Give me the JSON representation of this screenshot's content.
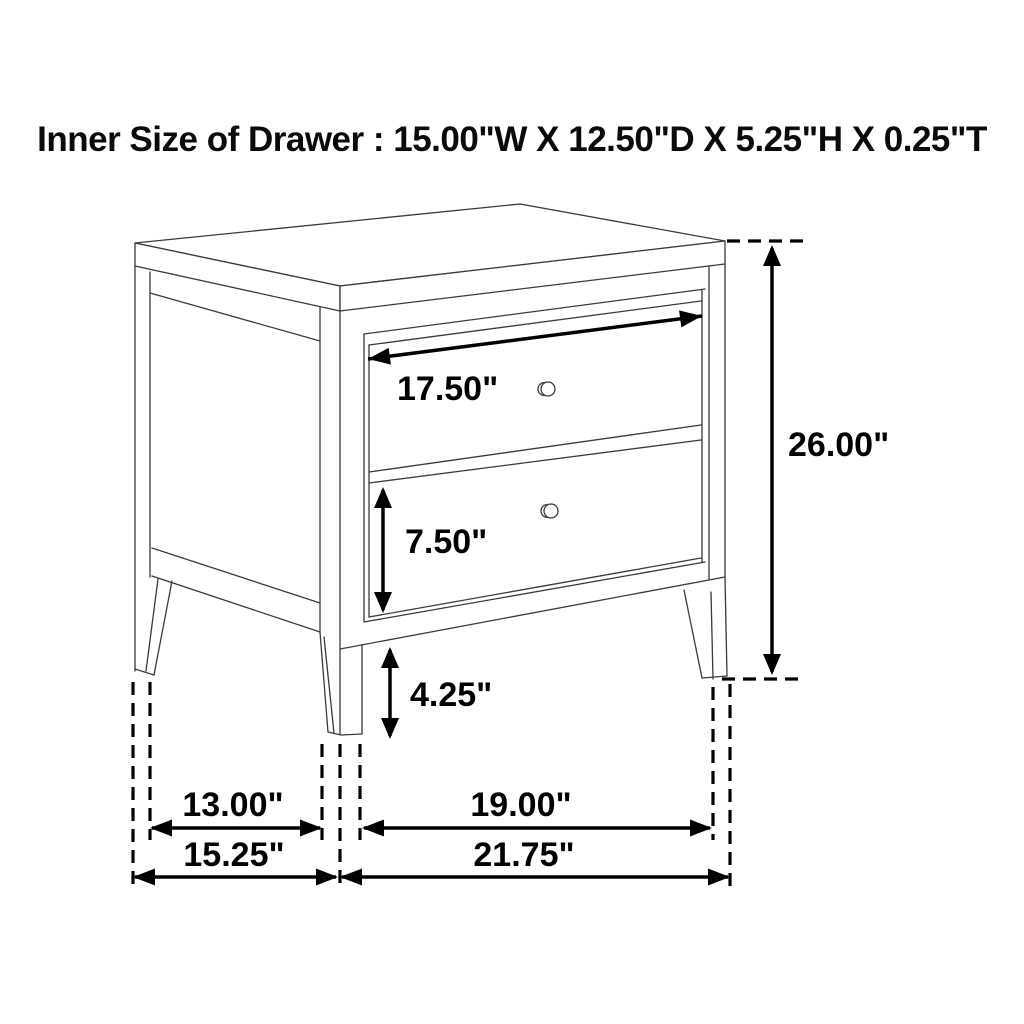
{
  "title": "Inner Size of Drawer : 15.00\"W X 12.50\"D X 5.25\"H X 0.25\"T",
  "dimensions": {
    "drawer_width": "17.50\"",
    "overall_height": "26.00\"",
    "bottom_drawer_height": "7.50\"",
    "leg_clearance": "4.25\"",
    "side_leg_span": "13.00\"",
    "side_depth": "15.25\"",
    "front_leg_span": "19.00\"",
    "front_width": "21.75\""
  },
  "colors": {
    "background": "#ffffff",
    "drawing_line": "#3a3a3a",
    "dimension_line": "#000000",
    "label_text": "#000000"
  }
}
